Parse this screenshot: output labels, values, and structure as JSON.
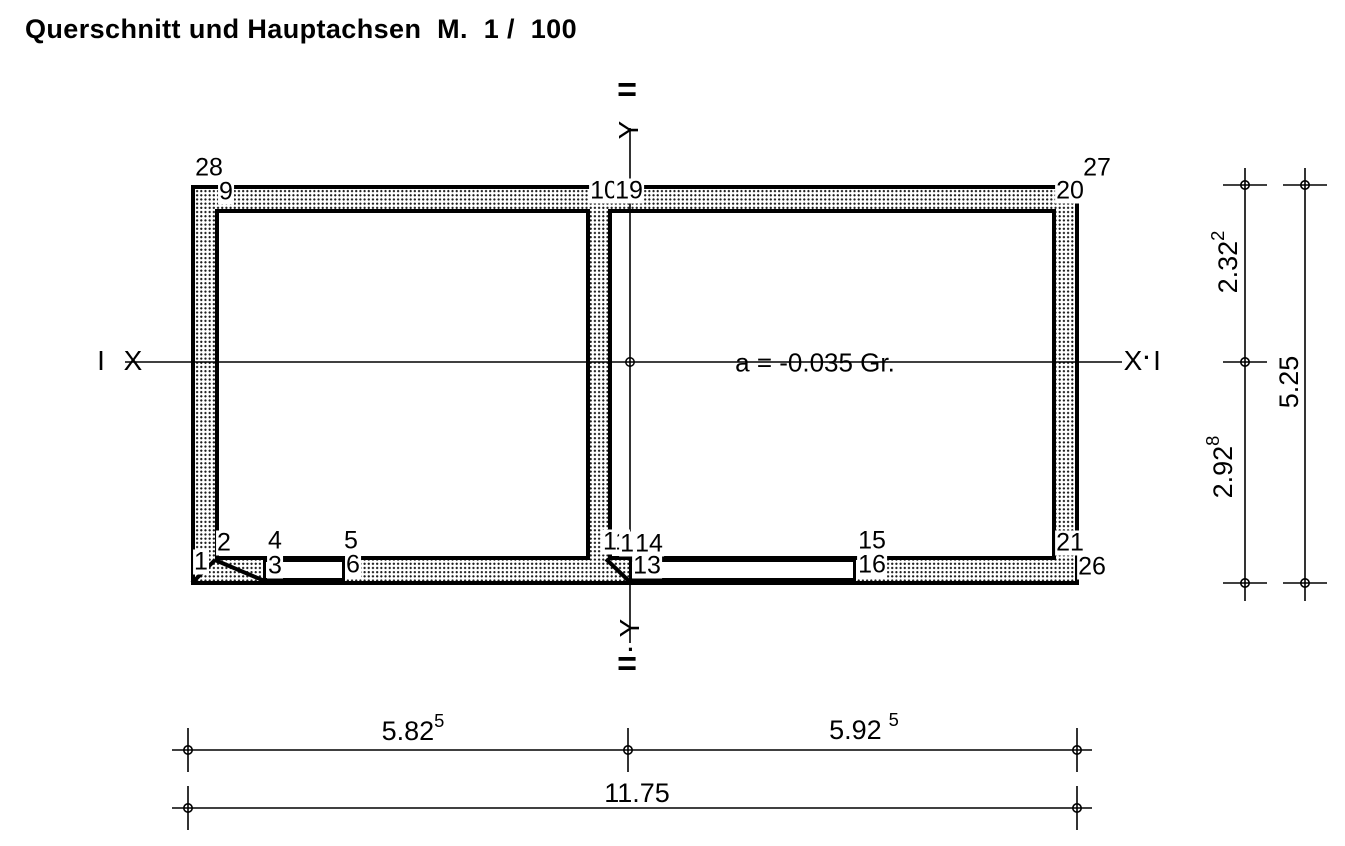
{
  "title": "Querschnitt und Hauptachsen  M.  1 /  100",
  "section": {
    "annotation": "a = -0.035 Gr.",
    "nodes": [
      {
        "label": "28"
      },
      {
        "label": "9"
      },
      {
        "label": "10"
      },
      {
        "label": "19"
      },
      {
        "label": "27"
      },
      {
        "label": "20"
      },
      {
        "label": "2"
      },
      {
        "label": "1"
      },
      {
        "label": "4"
      },
      {
        "label": "3"
      },
      {
        "label": "5"
      },
      {
        "label": "6"
      },
      {
        "label": "11"
      },
      {
        "label": "12"
      },
      {
        "label": "14"
      },
      {
        "label": "13"
      },
      {
        "label": "15"
      },
      {
        "label": "16"
      },
      {
        "label": "21"
      },
      {
        "label": "26"
      }
    ]
  },
  "axes": {
    "x_label_left_outer": "I",
    "x_label_left": "X",
    "x_label_right": "X",
    "x_separator": "·",
    "x_label_right_outer": "I",
    "y_label_top": "Y",
    "y_label_bottom": "Y",
    "y_mark_top": "=",
    "y_mark_bottom": "=",
    "y_dot_bottom": "·"
  },
  "dimensions": {
    "right": [
      {
        "value": "2.32",
        "sup": "2"
      },
      {
        "value": "2.92",
        "sup": "8"
      },
      {
        "value": "5.25",
        "sup": ""
      }
    ],
    "bottom": [
      {
        "value": "5.82",
        "sup": "5"
      },
      {
        "value": "5.92",
        "sup": "5"
      },
      {
        "value": "11.75",
        "sup": ""
      }
    ]
  },
  "colors": {
    "line": "#000000",
    "background": "#ffffff"
  }
}
